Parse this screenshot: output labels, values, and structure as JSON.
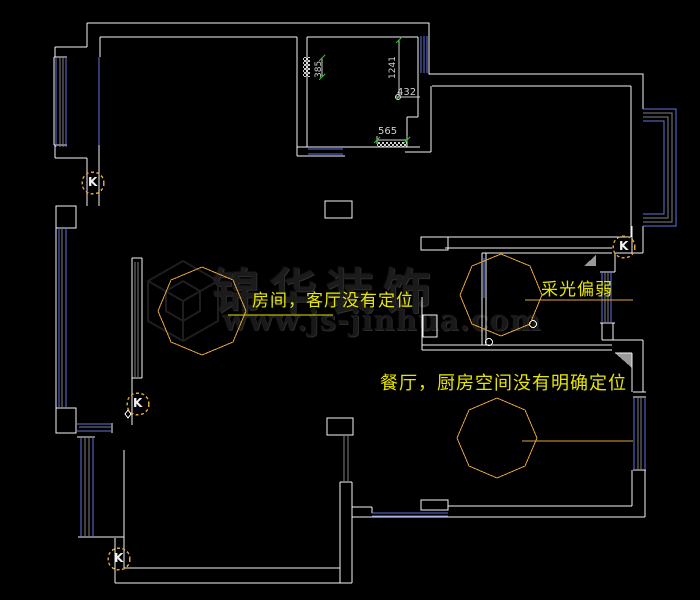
{
  "canvas": {
    "width": 700,
    "height": 600,
    "background": "#000000"
  },
  "colors": {
    "wall": "#f5f5f5",
    "window": "#5f74dd",
    "mullion": "#808080",
    "cloud": "#e2a23a",
    "note": "#e6e600",
    "dim": "#cfcfcf",
    "tick": "#2eb82e",
    "fill": "#9a9a9a",
    "watermark": "#1b1b1b"
  },
  "notes": {
    "room": "房间，客厅没有定位",
    "light": "采光偏弱",
    "dining": "餐厅，厨房空间没有明确定位"
  },
  "dimensions": {
    "d385": "385",
    "d1241": "1241",
    "d432": "432",
    "d565": "565"
  },
  "k_marker_label": "K",
  "watermark": {
    "title": "锦华装饰",
    "url": "www.js-jinhua.com"
  }
}
